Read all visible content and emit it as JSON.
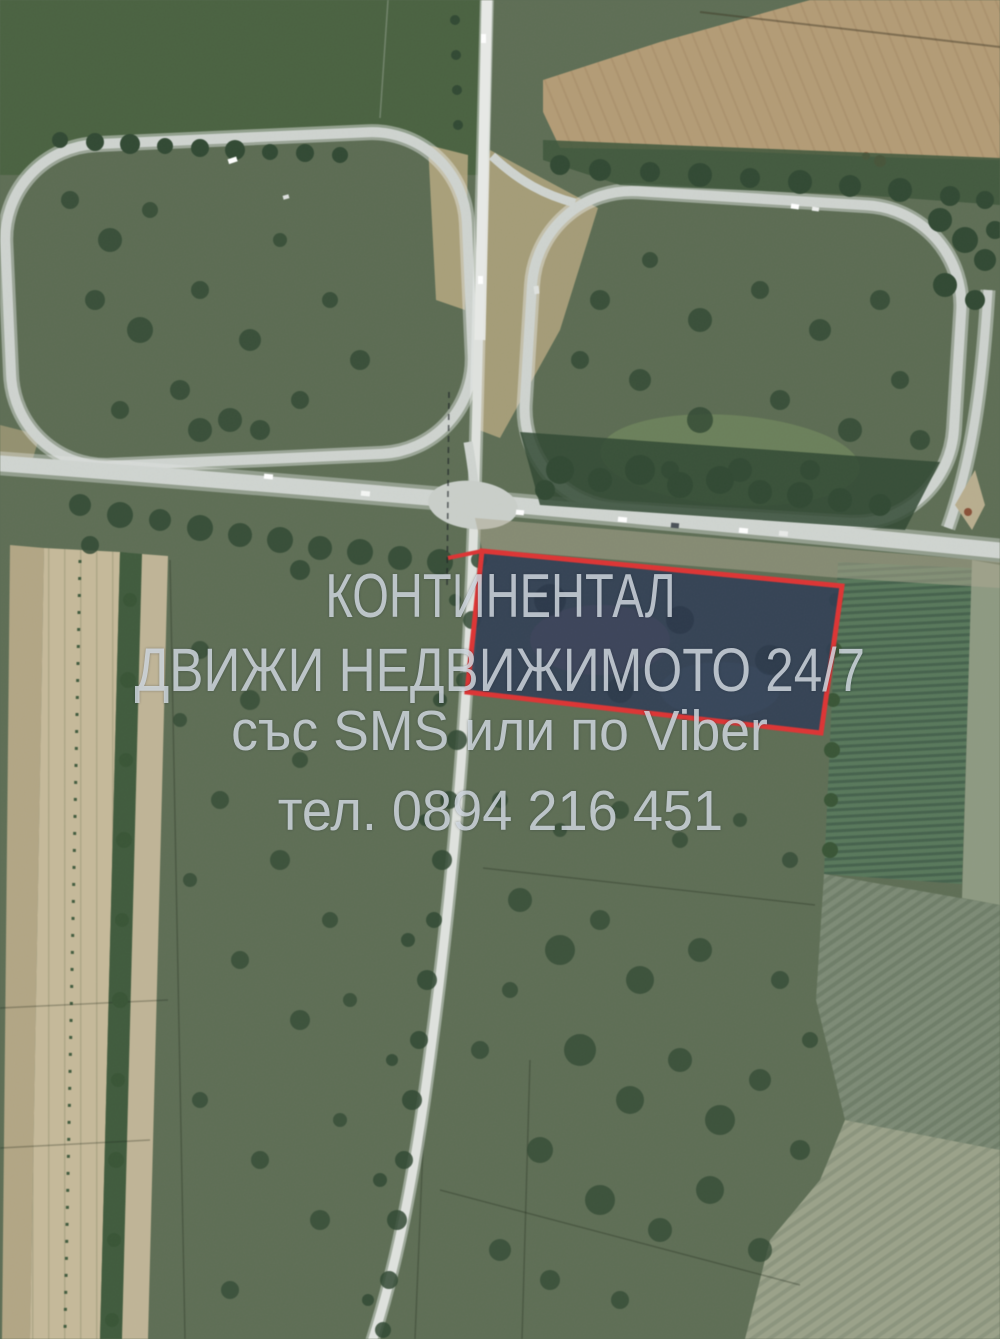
{
  "image_type": "satellite aerial photo of land plot with road interchange",
  "watermark": {
    "line1": "КОНТИНЕНТАЛ",
    "line2": "ДВИЖИ НЕДВИЖИМОТО 24/7",
    "line3": "със SMS или по Viber",
    "line4": "тел. 0894 216 451",
    "agency_name": "КОНТИНЕНТАЛ",
    "phone": "0894 216 451",
    "text_color": "rgba(213,221,228,0.82)"
  },
  "highlighted_plot": {
    "outline_color": "#e43131",
    "fill_color": "#2e3c55",
    "points_str": "482,551 842,586 821,733 467,692"
  },
  "palette": {
    "scrub_green": "#5c6d53",
    "pasture_dark_green": "#48613f",
    "plowed_field_tan": "#b49b73",
    "road_gray": "#cfd4d0",
    "tree_dark_green": "#2f4831",
    "vineyard_green": "#567759",
    "strip_field_pale": "#c6b997"
  }
}
